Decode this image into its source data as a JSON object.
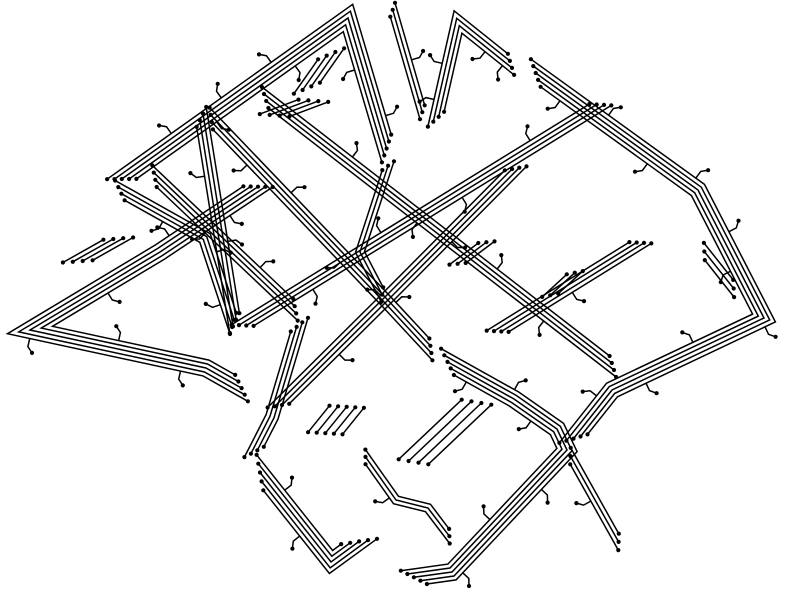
{
  "canvas": {
    "width": 800,
    "height": 600,
    "background_color": "#ffffff",
    "trace_color": "#000000",
    "line_width": 1.5,
    "line_gap": 4.2,
    "dot_radius": 2.1,
    "end_stagger": 6,
    "view_box": "0 0 800 600"
  },
  "bundles": [
    {
      "name": "fan-topleft-hairpin",
      "points": [
        [
          112,
          186
        ],
        [
          348,
          18
        ],
        [
          390,
          160
        ]
      ],
      "lines": 5,
      "taps": [
        {
          "t": 0.18,
          "s": -1
        },
        {
          "t": 0.32,
          "s": -1
        },
        {
          "t": 0.46,
          "s": -1
        },
        {
          "t": 0.28,
          "s": 1
        },
        {
          "t": 0.5,
          "s": 1
        },
        {
          "t": 0.78,
          "s": 1
        },
        {
          "t": 0.9,
          "s": -1
        }
      ]
    },
    {
      "name": "fan-topleft-apex-stub-row",
      "points": [
        [
          300,
          98
        ],
        [
          338,
          44
        ]
      ],
      "lines": 4,
      "gap": 5,
      "stagger": 8
    },
    {
      "name": "fan-topleft-left-stub-row",
      "points": [
        [
          262,
          120
        ],
        [
          326,
          96
        ]
      ],
      "lines": 4,
      "stagger": 9
    },
    {
      "name": "road-topleft-bottom",
      "points": [
        [
          112,
          186
        ],
        [
          205,
          238
        ],
        [
          236,
          332
        ]
      ],
      "lines": 4,
      "taps": [
        {
          "t": 0.3,
          "s": 1
        },
        {
          "t": 0.6,
          "s": -1
        },
        {
          "t": 0.85,
          "s": 1
        }
      ]
    },
    {
      "name": "fan-topright-hairpin",
      "points": [
        [
          434,
          128
        ],
        [
          458,
          22
        ],
        [
          518,
          70
        ]
      ],
      "lines": 4,
      "taps": [
        {
          "t": 0.15,
          "s": -1
        },
        {
          "t": 0.35,
          "s": -1
        },
        {
          "t": 0.8,
          "s": 1
        },
        {
          "t": 0.92,
          "s": 1
        }
      ]
    },
    {
      "name": "road-top-center",
      "points": [
        [
          391,
          4
        ],
        [
          424,
          118
        ]
      ],
      "lines": 3,
      "taps": [
        {
          "t": 0.5,
          "s": -1
        }
      ]
    },
    {
      "name": "road-topright-to-right-wedge",
      "points": [
        [
          526,
          66
        ],
        [
          698,
          190
        ],
        [
          764,
          318
        ],
        [
          612,
          390
        ],
        [
          566,
          448
        ]
      ],
      "lines": 5,
      "taps": [
        {
          "t": 0.08,
          "s": 1
        },
        {
          "t": 0.16,
          "s": -1
        },
        {
          "t": 0.26,
          "s": 1
        },
        {
          "t": 0.34,
          "s": -1
        },
        {
          "t": 0.44,
          "s": -1
        },
        {
          "t": 0.5,
          "s": 1
        },
        {
          "t": 0.6,
          "s": -1
        },
        {
          "t": 0.72,
          "s": 1
        },
        {
          "t": 0.82,
          "s": -1
        },
        {
          "t": 0.9,
          "s": 1
        }
      ]
    },
    {
      "name": "road-left-wedge",
      "points": [
        [
          268,
          180
        ],
        [
          160,
          252
        ],
        [
          30,
          330
        ],
        [
          206,
          368
        ],
        [
          252,
          394
        ]
      ],
      "lines": 5,
      "taps": [
        {
          "t": 0.1,
          "s": -1
        },
        {
          "t": 0.22,
          "s": 1
        },
        {
          "t": 0.38,
          "s": -1
        },
        {
          "t": 0.55,
          "s": 1
        },
        {
          "t": 0.72,
          "s": -1
        },
        {
          "t": 0.85,
          "s": 1
        }
      ]
    },
    {
      "name": "stub-left-wedge-row",
      "points": [
        [
          66,
          268
        ],
        [
          130,
          232
        ]
      ],
      "lines": 4,
      "stagger": 9
    },
    {
      "name": "lattice-road-nwse-main",
      "points": [
        [
          205,
          112
        ],
        [
          385,
          300
        ],
        [
          437,
          356
        ]
      ],
      "lines": 4,
      "taps": [
        {
          "t": 0.2,
          "s": 1
        },
        {
          "t": 0.35,
          "s": -1
        },
        {
          "t": 0.6,
          "s": 1
        },
        {
          "t": 0.8,
          "s": -1
        }
      ]
    },
    {
      "name": "lattice-road-nwse-upper",
      "points": [
        [
          258,
          92
        ],
        [
          620,
          372
        ]
      ],
      "lines": 4,
      "taps": [
        {
          "t": 0.25,
          "s": -1
        },
        {
          "t": 0.45,
          "s": 1
        },
        {
          "t": 0.65,
          "s": -1
        },
        {
          "t": 0.8,
          "s": 1
        }
      ]
    },
    {
      "name": "lattice-road-nwse-lower",
      "points": [
        [
          148,
          170
        ],
        [
          302,
          316
        ]
      ],
      "lines": 4,
      "taps": [
        {
          "t": 0.4,
          "s": 1
        },
        {
          "t": 0.7,
          "s": -1
        }
      ]
    },
    {
      "name": "lattice-road-nesw-long",
      "points": [
        [
          608,
          100
        ],
        [
          235,
          330
        ]
      ],
      "lines": 4,
      "taps": [
        {
          "t": 0.2,
          "s": 1
        },
        {
          "t": 0.4,
          "s": -1
        },
        {
          "t": 0.6,
          "s": 1
        },
        {
          "t": 0.8,
          "s": -1
        }
      ]
    },
    {
      "name": "lattice-road-nesw-center",
      "points": [
        [
          522,
          162
        ],
        [
          385,
          300
        ],
        [
          272,
          412
        ]
      ],
      "lines": 4,
      "taps": [
        {
          "t": 0.3,
          "s": -1
        },
        {
          "t": 0.55,
          "s": 1
        },
        {
          "t": 0.75,
          "s": -1
        }
      ]
    },
    {
      "name": "lattice-road-nesw-right",
      "points": [
        [
          648,
          238
        ],
        [
          490,
          336
        ]
      ],
      "lines": 4,
      "taps": [
        {
          "t": 0.5,
          "s": -1
        }
      ]
    },
    {
      "name": "road-left-steep",
      "points": [
        [
          200,
          108
        ],
        [
          236,
          332
        ]
      ],
      "lines": 4,
      "taps": [
        {
          "t": 0.3,
          "s": 1
        },
        {
          "t": 0.6,
          "s": -1
        }
      ]
    },
    {
      "name": "road-center-steep",
      "points": [
        [
          390,
          160
        ],
        [
          360,
          252
        ],
        [
          385,
          300
        ]
      ],
      "lines": 3
    },
    {
      "name": "road-bottomleft-link",
      "points": [
        [
          302,
          316
        ],
        [
          272,
          417
        ],
        [
          250,
          460
        ]
      ],
      "lines": 4
    },
    {
      "name": "loop-bottomleft-uturn",
      "points": [
        [
          250,
          460
        ],
        [
          331,
          562
        ],
        [
          372,
          532
        ]
      ],
      "lines": 5,
      "stagger": 8,
      "taps": [
        {
          "t": 0.25,
          "s": -1
        },
        {
          "t": 0.5,
          "s": 1
        }
      ]
    },
    {
      "name": "loop-bottomright-edge",
      "points": [
        [
          437,
          356
        ],
        [
          514,
          399
        ],
        [
          557,
          429
        ],
        [
          567,
          450
        ],
        [
          452,
          572
        ],
        [
          402,
          579
        ]
      ],
      "lines": 5,
      "taps": [
        {
          "t": 0.1,
          "s": 1
        },
        {
          "t": 0.22,
          "s": -1
        },
        {
          "t": 0.3,
          "s": 1
        },
        {
          "t": 0.55,
          "s": -1
        },
        {
          "t": 0.7,
          "s": 1
        },
        {
          "t": 0.85,
          "s": -1
        }
      ]
    },
    {
      "name": "stub-bottom-short-row",
      "points": [
        [
          319,
          441
        ],
        [
          353,
          399
        ]
      ],
      "lines": 5,
      "gap": 7,
      "stagger": 5
    },
    {
      "name": "stub-bottom-long-row",
      "points": [
        [
          407,
          468
        ],
        [
          483,
          396
        ]
      ],
      "lines": 4,
      "gap": 8,
      "stagger": 6
    },
    {
      "name": "road-bottom-funnel",
      "points": [
        [
          362,
          452
        ],
        [
          396,
          500
        ],
        [
          428,
          508
        ],
        [
          453,
          541
        ]
      ],
      "lines": 3,
      "taps": [
        {
          "t": 0.4,
          "s": 1
        }
      ]
    },
    {
      "name": "stub-center-row",
      "points": [
        [
          452,
          268
        ],
        [
          492,
          238
        ]
      ],
      "lines": 3,
      "stagger": 7
    },
    {
      "name": "stub-right-inner-row",
      "points": [
        [
          700,
          246
        ],
        [
          738,
          294
        ]
      ],
      "lines": 3,
      "gap": 5,
      "stagger": 7
    },
    {
      "name": "stub-mid-right-row",
      "points": [
        [
          545,
          300
        ],
        [
          580,
          268
        ]
      ],
      "lines": 3,
      "stagger": 7
    },
    {
      "name": "road-bottomright-tail",
      "points": [
        [
          567,
          450
        ],
        [
          622,
          548
        ]
      ],
      "lines": 3,
      "stagger": 7,
      "taps": [
        {
          "t": 0.5,
          "s": 1
        }
      ]
    }
  ]
}
